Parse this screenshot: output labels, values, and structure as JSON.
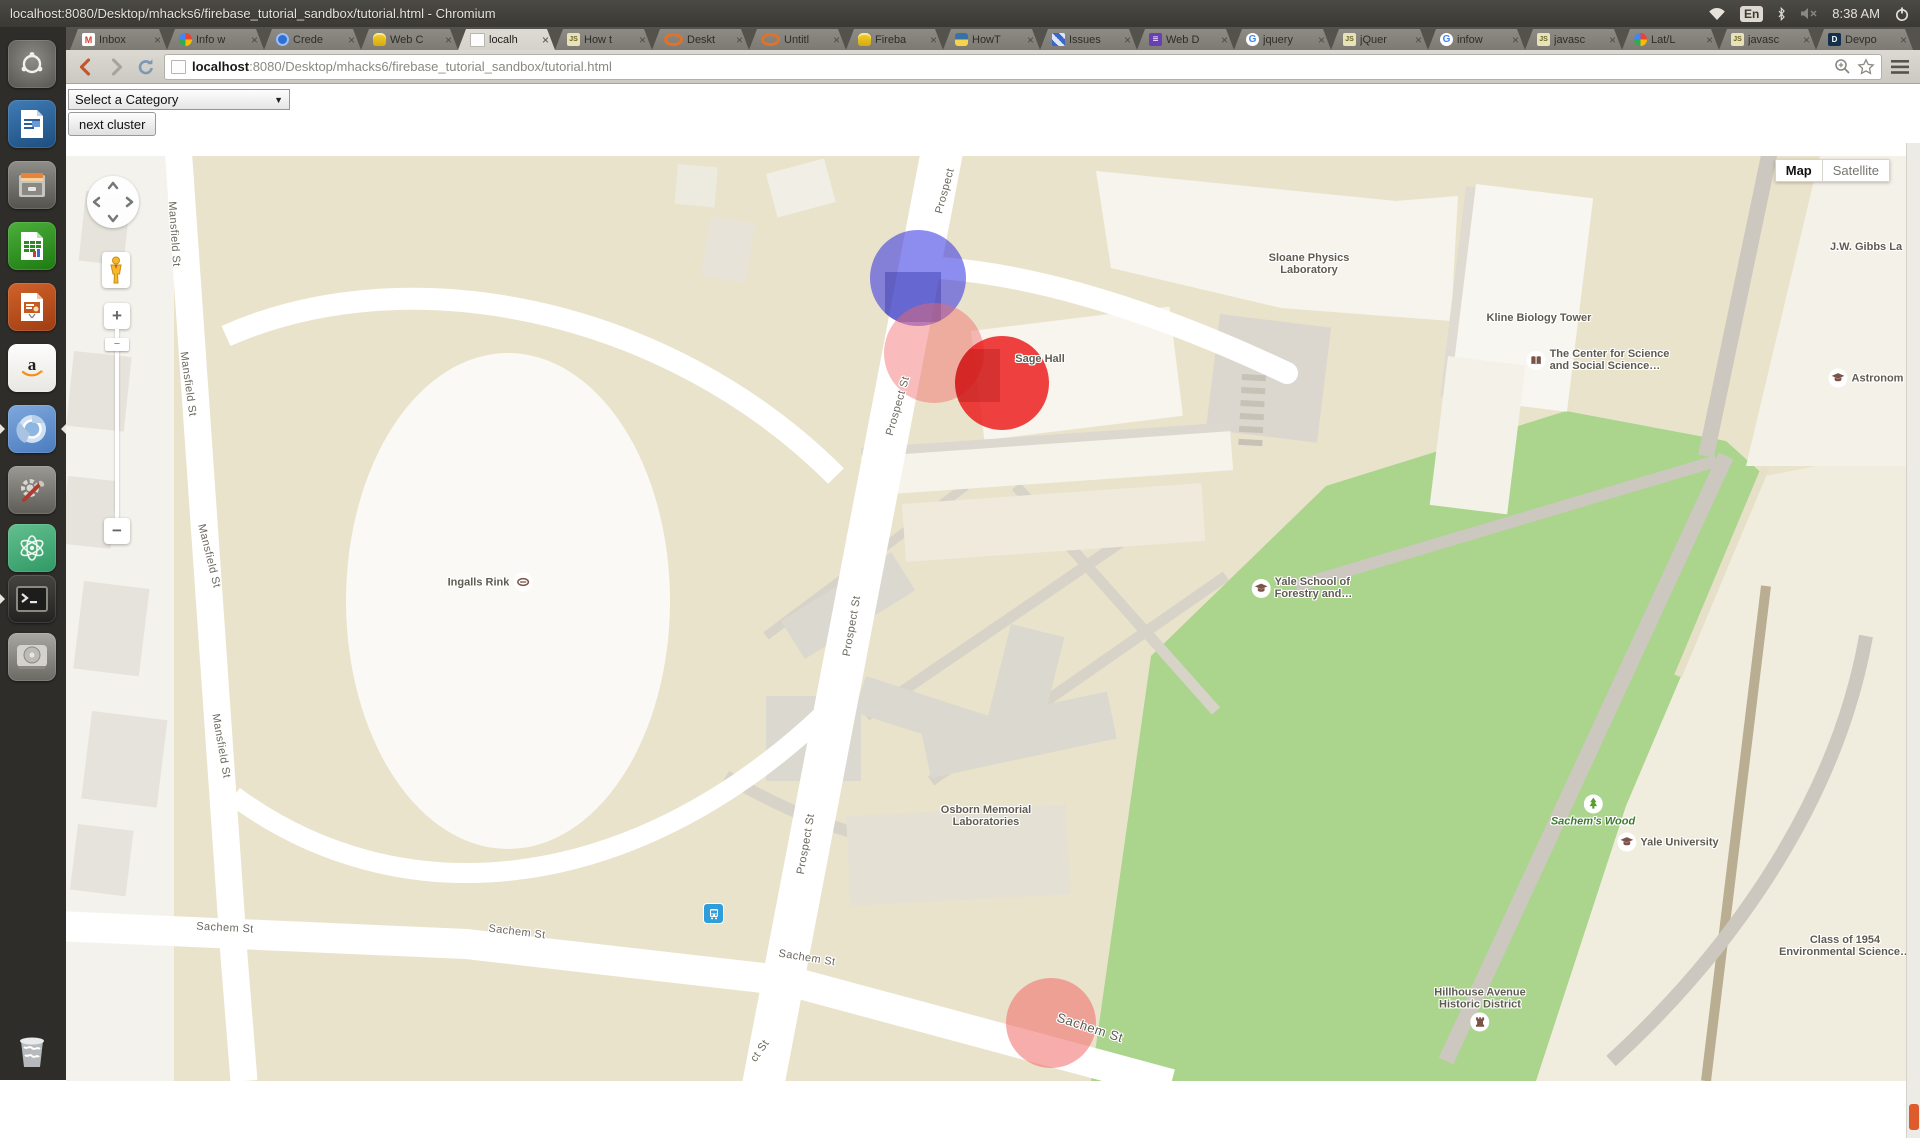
{
  "panel": {
    "title": "localhost:8080/Desktop/mhacks6/firebase_tutorial_sandbox/tutorial.html - Chromium",
    "keyboard_indicator": "En",
    "time": "8:38 AM",
    "tray_icons": [
      "network-wifi-icon",
      "keyboard-layout-indicator",
      "bluetooth-icon",
      "volume-muted-icon",
      "clock",
      "session-power-icon"
    ]
  },
  "tabs": [
    {
      "label": "Inbox",
      "icon": "gmail",
      "close": "×",
      "active": false
    },
    {
      "label": "Info w",
      "icon": "google-colors",
      "close": "×",
      "active": false
    },
    {
      "label": "Crede",
      "icon": "blue-badge",
      "close": "×",
      "active": false
    },
    {
      "label": "Web C",
      "icon": "database",
      "close": "×",
      "active": false
    },
    {
      "label": "localh",
      "icon": "page",
      "close": "×",
      "active": true
    },
    {
      "label": "How t",
      "icon": "js",
      "close": "×",
      "active": false
    },
    {
      "label": "Deskt",
      "icon": "orange-circle",
      "close": "×",
      "active": false
    },
    {
      "label": "Untitl",
      "icon": "orange-circle",
      "close": "×",
      "active": false
    },
    {
      "label": "Fireba",
      "icon": "database",
      "close": "×",
      "active": false
    },
    {
      "label": "HowT",
      "icon": "python",
      "close": "×",
      "active": false
    },
    {
      "label": "Issues",
      "icon": "pixel",
      "close": "×",
      "active": false
    },
    {
      "label": "Web D",
      "icon": "purple-list",
      "close": "×",
      "active": false
    },
    {
      "label": "jquery",
      "icon": "google-g",
      "close": "×",
      "active": false
    },
    {
      "label": "jQuer",
      "icon": "js",
      "close": "×",
      "active": false
    },
    {
      "label": "infow",
      "icon": "google-g",
      "close": "×",
      "active": false
    },
    {
      "label": "javasc",
      "icon": "js",
      "close": "×",
      "active": false
    },
    {
      "label": "Lat/L",
      "icon": "google-colors",
      "close": "×",
      "active": false
    },
    {
      "label": "javasc",
      "icon": "js",
      "close": "×",
      "active": false
    },
    {
      "label": "Devpo",
      "icon": "devpost",
      "close": "×",
      "active": false
    }
  ],
  "toolbar": {
    "url_host": "localhost",
    "url_rest": ":8080/Desktop/mhacks6/firebase_tutorial_sandbox/tutorial.html"
  },
  "controls": {
    "category_select": "Select a Category",
    "select_arrow": "▼",
    "next_cluster": "next cluster"
  },
  "launcher": {
    "items": [
      {
        "name": "dash-home",
        "icon": "dash",
        "y": 13
      },
      {
        "name": "libreoffice-writer",
        "icon": "writer",
        "y": 73
      },
      {
        "name": "file-archive",
        "icon": "cabinet",
        "y": 134
      },
      {
        "name": "libreoffice-calc",
        "icon": "calc",
        "y": 195
      },
      {
        "name": "libreoffice-impress",
        "icon": "impress",
        "y": 256
      },
      {
        "name": "amazon",
        "icon": "amazon",
        "y": 317
      },
      {
        "name": "chromium-browser",
        "icon": "chromium",
        "y": 378,
        "focused": true,
        "running": true
      },
      {
        "name": "system-settings",
        "icon": "settings",
        "y": 439
      },
      {
        "name": "atom-editor",
        "icon": "atom",
        "y": 497
      },
      {
        "name": "terminal",
        "icon": "terminal",
        "y": 548,
        "running": true
      },
      {
        "name": "hard-disk",
        "icon": "hdd",
        "y": 606
      },
      {
        "name": "trash",
        "icon": "trash",
        "y": 1000
      }
    ]
  },
  "map": {
    "type_map": "Map",
    "type_satellite": "Satellite",
    "labels": [
      {
        "kind": "street",
        "lines": [
          "Mansfield St"
        ],
        "x": 108,
        "y": 78,
        "rot": 86
      },
      {
        "kind": "street",
        "lines": [
          "Mansfield St"
        ],
        "x": 122,
        "y": 228,
        "rot": 82
      },
      {
        "kind": "street",
        "lines": [
          "Mansfield St"
        ],
        "x": 143,
        "y": 400,
        "rot": 76
      },
      {
        "kind": "street",
        "lines": [
          "Mansfield St"
        ],
        "x": 155,
        "y": 590,
        "rot": 80
      },
      {
        "kind": "street",
        "lines": [
          "Prospect"
        ],
        "x": 879,
        "y": 35,
        "rot": -75
      },
      {
        "kind": "street",
        "lines": [
          "Prospect St"
        ],
        "x": 832,
        "y": 250,
        "rot": -74
      },
      {
        "kind": "street",
        "lines": [
          "Prospect St"
        ],
        "x": 786,
        "y": 470,
        "rot": -80
      },
      {
        "kind": "street",
        "lines": [
          "Prospect St"
        ],
        "x": 740,
        "y": 688,
        "rot": -80
      },
      {
        "kind": "street",
        "lines": [
          "ct St"
        ],
        "x": 694,
        "y": 895,
        "rot": -55
      },
      {
        "kind": "street",
        "lines": [
          "Sachem St"
        ],
        "x": 159,
        "y": 772,
        "rot": 3
      },
      {
        "kind": "street",
        "lines": [
          "Sachem St"
        ],
        "x": 451,
        "y": 776,
        "rot": 7
      },
      {
        "kind": "street",
        "lines": [
          "Sachem St"
        ],
        "x": 741,
        "y": 802,
        "rot": 9
      },
      {
        "kind": "street-lg",
        "lines": [
          "Sachem St"
        ],
        "x": 1024,
        "y": 872,
        "rot": 18
      },
      {
        "kind": "poi",
        "lines": [
          "Sloane Physics",
          "Laboratory"
        ],
        "x": 1243,
        "y": 108
      },
      {
        "kind": "poi",
        "lines": [
          "Kline Biology Tower"
        ],
        "x": 1473,
        "y": 162
      },
      {
        "kind": "poi",
        "icon": "book-icon",
        "iconPos": "left",
        "align": "left",
        "lines": [
          "The Center for Science",
          "and Social Science…"
        ],
        "x": 1532,
        "y": 204
      },
      {
        "kind": "poi",
        "lines": [
          "J.W. Gibbs La"
        ],
        "x": 1800,
        "y": 91
      },
      {
        "kind": "poi",
        "icon": "grad-cap-icon",
        "iconPos": "left",
        "lines": [
          "Astronom"
        ],
        "x": 1800,
        "y": 222
      },
      {
        "kind": "poi",
        "lines": [
          "Sage Hall"
        ],
        "x": 974,
        "y": 203
      },
      {
        "kind": "poi",
        "icon": "grad-cap-icon",
        "iconPos": "left",
        "align": "left",
        "lines": [
          "Yale School of",
          "Forestry and…"
        ],
        "x": 1236,
        "y": 432
      },
      {
        "kind": "poi",
        "lines": [
          "Osborn Memorial",
          "Laboratories"
        ],
        "x": 920,
        "y": 660
      },
      {
        "kind": "poi",
        "icon": "rink-icon",
        "iconPos": "right",
        "lines": [
          "Ingalls Rink"
        ],
        "x": 424,
        "y": 426
      },
      {
        "kind": "park",
        "icon": "tree-icon",
        "iconPos": "above",
        "lines": [
          "Sachem's Wood"
        ],
        "x": 1527,
        "y": 655
      },
      {
        "kind": "poi",
        "icon": "grad-cap-icon",
        "iconPos": "left",
        "lines": [
          "Yale University"
        ],
        "x": 1602,
        "y": 686
      },
      {
        "kind": "poi",
        "icon": "tower-icon",
        "iconPos": "below",
        "lines": [
          "Hillhouse Avenue",
          "Historic District"
        ],
        "x": 1414,
        "y": 853
      },
      {
        "kind": "poi",
        "lines": [
          "Class of 1954",
          "Environmental Science…"
        ],
        "x": 1779,
        "y": 790
      }
    ],
    "markers": [
      {
        "name": "cluster-blue",
        "x": 852,
        "y": 122,
        "r": 48,
        "color": "rgba(48,48,225,0.55)",
        "shade": {
          "l": "16%",
          "t": "44%",
          "w": "58%",
          "h": "52%",
          "c": "rgba(25,25,150,0.32)"
        }
      },
      {
        "name": "cluster-pink-top",
        "x": 868,
        "y": 197,
        "r": 50,
        "color": "rgba(242,105,105,0.45)"
      },
      {
        "name": "cluster-red",
        "x": 936,
        "y": 227,
        "r": 47,
        "color": "rgba(234,25,25,0.82)",
        "shade": {
          "l": "0%",
          "t": "14%",
          "w": "48%",
          "h": "56%",
          "c": "rgba(130,0,0,0.22)"
        }
      },
      {
        "name": "cluster-pink-bottom",
        "x": 985,
        "y": 867,
        "r": 45,
        "color": "rgba(242,105,105,0.55)"
      }
    ]
  }
}
